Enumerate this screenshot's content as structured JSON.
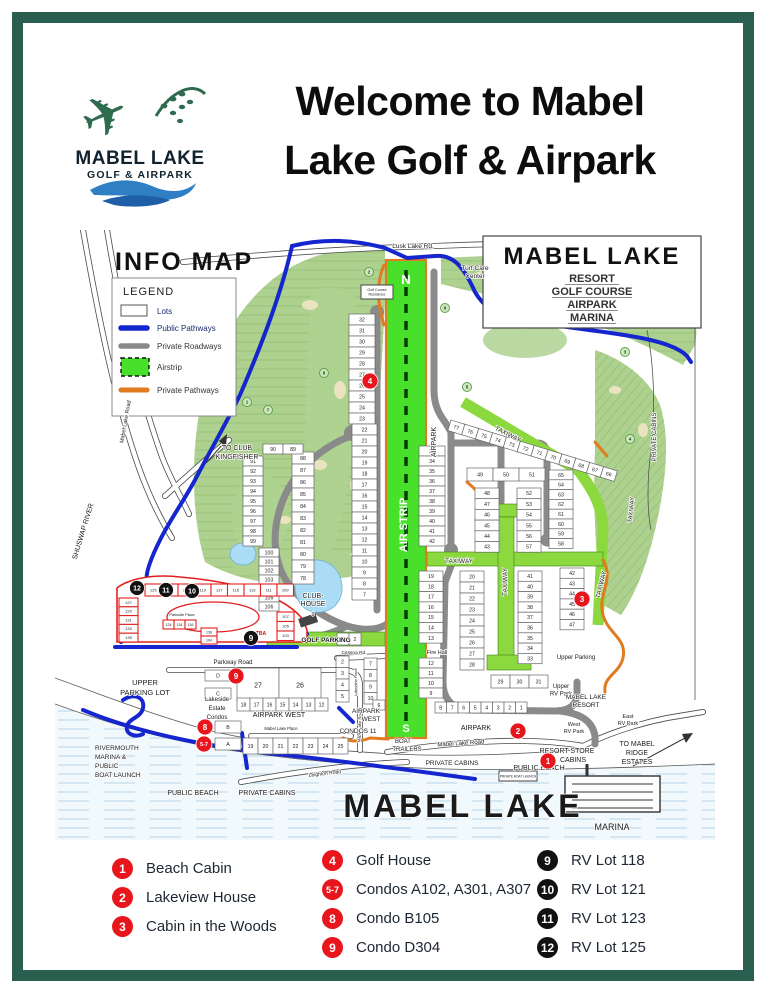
{
  "colors": {
    "border": "#2a5f50",
    "red": "#e8151d",
    "black": "#111111",
    "course": "#aed190",
    "airstrip": "#49e02c",
    "taxiway": "#8cd93f",
    "blue": "#1526cf",
    "gray": "#8a8a8a",
    "orange": "#e07b20",
    "water": "#f2f9fd",
    "redlot": "#e32020"
  },
  "logo": {
    "name": "MABEL LAKE",
    "subtitle": "GOLF & AIRPARK"
  },
  "header": {
    "title_line1": "Welcome to Mabel",
    "title_line2": "Lake Golf & Airpark"
  },
  "map": {
    "info_title": "INFO MAP",
    "legend": {
      "title": "LEGEND",
      "items": [
        {
          "label": "Lots",
          "type": "lots"
        },
        {
          "label": "Public Pathways",
          "type": "public-pathway"
        },
        {
          "label": "Private Roadways",
          "type": "private-roadway"
        },
        {
          "label": "Airstrip",
          "type": "airstrip"
        },
        {
          "label": "Private Pathways",
          "type": "private-pathway"
        }
      ]
    },
    "resort_box": {
      "title": "MABEL LAKE",
      "lines": [
        "RESORT",
        "GOLF COURSE",
        "AIRPARK",
        "MARINA"
      ]
    },
    "labels": [
      {
        "t": "Lusk Lake Rd.",
        "x": 358,
        "y": 18,
        "s": 6.5
      },
      {
        "t": "Turf Care",
        "x": 420,
        "y": 40,
        "s": 6.5
      },
      {
        "t": "Center",
        "x": 420,
        "y": 48,
        "s": 6.5
      },
      {
        "t": "Golf Course",
        "x": 322,
        "y": 61,
        "s": 3.6
      },
      {
        "t": "Residence",
        "x": 322,
        "y": 65.5,
        "s": 3.6
      },
      {
        "t": "TO CLUB",
        "x": 182,
        "y": 220,
        "s": 7
      },
      {
        "t": "KINGFISHER",
        "x": 182,
        "y": 229,
        "s": 7
      },
      {
        "t": "Mabel Lake Road",
        "x": 72,
        "y": 192,
        "s": 5.5,
        "r": -80
      },
      {
        "t": "SHUSWAP RIVER",
        "x": 30,
        "y": 302,
        "s": 7,
        "r": -73
      },
      {
        "t": "N",
        "x": 351,
        "y": 54,
        "s": 13,
        "b": true,
        "c": "#ffffff"
      },
      {
        "t": "AIR STRIP",
        "x": 352,
        "y": 295,
        "s": 11,
        "b": true,
        "c": "#ffffff",
        "r": -90
      },
      {
        "t": "S",
        "x": 351,
        "y": 502,
        "s": 11,
        "b": true,
        "c": "#ffffff"
      },
      {
        "t": "AIRPARK",
        "x": 381,
        "y": 212,
        "s": 7,
        "r": -90
      },
      {
        "t": "TAXIWAY",
        "x": 452,
        "y": 206,
        "s": 6.5,
        "r": 27
      },
      {
        "t": "TAXIWAY",
        "x": 578,
        "y": 280,
        "s": 6,
        "r": -84
      },
      {
        "t": "TAXIWAY",
        "x": 404,
        "y": 333,
        "s": 6.5
      },
      {
        "t": "TAXIWAY",
        "x": 452,
        "y": 352,
        "s": 6.5,
        "r": -90
      },
      {
        "t": "TAXIWAY",
        "x": 548,
        "y": 355,
        "s": 6.5,
        "r": -76
      },
      {
        "t": "CLUB-",
        "x": 258,
        "y": 368,
        "s": 7
      },
      {
        "t": "HOUSE",
        "x": 258,
        "y": 376,
        "s": 7
      },
      {
        "t": "9",
        "x": 258,
        "y": 386,
        "s": 5.5
      },
      {
        "t": "GOLF PARKING",
        "x": 271,
        "y": 412,
        "s": 6.5,
        "b": true
      },
      {
        "t": "Cessna Rd.",
        "x": 299,
        "y": 424,
        "s": 4.8
      },
      {
        "t": "Lakeview Place",
        "x": 302,
        "y": 452,
        "s": 4,
        "r": -90
      },
      {
        "t": "Fire Hall",
        "x": 382,
        "y": 424,
        "s": 5.5
      },
      {
        "t": "Upper Parking",
        "x": 521,
        "y": 429,
        "s": 6
      },
      {
        "t": "Upper",
        "x": 506,
        "y": 458,
        "s": 6
      },
      {
        "t": "RV Park",
        "x": 506,
        "y": 465.5,
        "s": 6
      },
      {
        "t": "MABEL LAKE",
        "x": 531,
        "y": 469,
        "s": 6.5
      },
      {
        "t": "RESORT",
        "x": 531,
        "y": 477,
        "s": 6.5
      },
      {
        "t": "West",
        "x": 519,
        "y": 496,
        "s": 5.5
      },
      {
        "t": "RV Park",
        "x": 519,
        "y": 503,
        "s": 5.5
      },
      {
        "t": "East",
        "x": 573,
        "y": 488,
        "s": 5.5
      },
      {
        "t": "RV Park",
        "x": 573,
        "y": 495,
        "s": 5.5
      },
      {
        "t": "AIRPARK",
        "x": 421,
        "y": 500,
        "s": 7
      },
      {
        "t": "Mabel Lake Road",
        "x": 406,
        "y": 515,
        "s": 6,
        "r": -4
      },
      {
        "t": "Mabel Lake Road",
        "x": 306,
        "y": 496,
        "s": 4.2,
        "r": -88
      },
      {
        "t": "AIRPARK",
        "x": 311,
        "y": 483,
        "s": 6.5
      },
      {
        "t": "WEST",
        "x": 316,
        "y": 491,
        "s": 6.5
      },
      {
        "t": "CONDOS 11",
        "x": 303,
        "y": 503,
        "s": 6.5
      },
      {
        "t": "BOAT",
        "x": 348,
        "y": 513,
        "s": 6
      },
      {
        "t": "TRAILERS",
        "x": 352,
        "y": 521,
        "s": 6
      },
      {
        "t": "Parkside Place",
        "x": 127,
        "y": 386,
        "s": 3.8
      },
      {
        "t": "TBA",
        "x": 206,
        "y": 405,
        "s": 5,
        "b": true,
        "c": "#cc1111"
      },
      {
        "t": "Parkway Road",
        "x": 178,
        "y": 434,
        "s": 6
      },
      {
        "t": "UPPER",
        "x": 90,
        "y": 455,
        "s": 7.5
      },
      {
        "t": "PARKING LOT",
        "x": 90,
        "y": 465,
        "s": 7.5
      },
      {
        "t": "Lakeside",
        "x": 162,
        "y": 471,
        "s": 6
      },
      {
        "t": "Estate",
        "x": 162,
        "y": 480,
        "s": 6
      },
      {
        "t": "Condos",
        "x": 162,
        "y": 489,
        "s": 6
      },
      {
        "t": "AIRPARK WEST",
        "x": 224,
        "y": 487,
        "s": 7
      },
      {
        "t": "Mabel Lake Place",
        "x": 226,
        "y": 500,
        "s": 4.2
      },
      {
        "t": "Leighton Road",
        "x": 270,
        "y": 545,
        "s": 5,
        "r": -7
      },
      {
        "t": "PRIVATE CABINS",
        "x": 212,
        "y": 565,
        "s": 7
      },
      {
        "t": "PRIVATE CABINS",
        "x": 397,
        "y": 535,
        "s": 6.5
      },
      {
        "t": "PRIVATE CABINS",
        "x": 601,
        "y": 207,
        "s": 6,
        "r": -90
      },
      {
        "t": "RIVERMOUTH",
        "x": 40,
        "y": 520,
        "s": 6.5,
        "a": "start"
      },
      {
        "t": "MARINA &",
        "x": 40,
        "y": 529,
        "s": 6.5,
        "a": "start"
      },
      {
        "t": "PUBLIC",
        "x": 40,
        "y": 538,
        "s": 6.5,
        "a": "start"
      },
      {
        "t": "BOAT LAUNCH",
        "x": 40,
        "y": 547,
        "s": 6.5,
        "a": "start"
      },
      {
        "t": "PUBLIC BEACH",
        "x": 138,
        "y": 565,
        "s": 7
      },
      {
        "t": "PUBLIC BEACH",
        "x": 484,
        "y": 540,
        "s": 7
      },
      {
        "t": "RESORT STORE",
        "x": 512,
        "y": 523,
        "s": 7
      },
      {
        "t": "CABINS",
        "x": 518,
        "y": 532,
        "s": 7
      },
      {
        "t": "TO MABEL",
        "x": 582,
        "y": 516,
        "s": 7
      },
      {
        "t": "RIDGE",
        "x": 582,
        "y": 525,
        "s": 7
      },
      {
        "t": "ESTATES",
        "x": 582,
        "y": 534,
        "s": 7
      },
      {
        "t": "MABEL LAKE",
        "x": 408,
        "y": 587,
        "s": 32,
        "w": "600",
        "sp": 3
      },
      {
        "t": "MARINA",
        "x": 557,
        "y": 600,
        "s": 9
      },
      {
        "t": "PRIVATE BOAT LAUNCH",
        "x": 463,
        "y": 547.5,
        "s": 3.2
      }
    ],
    "holes": [
      {
        "n": "1",
        "x": 192,
        "y": 172
      },
      {
        "n": "7",
        "x": 213,
        "y": 180
      },
      {
        "n": "8",
        "x": 269,
        "y": 143
      },
      {
        "n": "2",
        "x": 314,
        "y": 42
      },
      {
        "n": "6",
        "x": 390,
        "y": 78
      },
      {
        "n": "5",
        "x": 412,
        "y": 157
      },
      {
        "n": "3",
        "x": 570,
        "y": 122
      },
      {
        "n": "4",
        "x": 575,
        "y": 209
      }
    ],
    "lot_groups": [
      {
        "x": 294,
        "y": 84,
        "cw": 26,
        "ch": 11,
        "dir": "v",
        "nums": [
          "32",
          "31",
          "30",
          "29",
          "28",
          "27",
          "26",
          "25",
          "24",
          "23"
        ]
      },
      {
        "x": 297,
        "y": 194,
        "cw": 25,
        "ch": 11,
        "dir": "v",
        "nums": [
          "22",
          "21",
          "20",
          "19",
          "18",
          "17",
          "16",
          "15",
          "14",
          "13",
          "12",
          "11",
          "10",
          "9",
          "8",
          "7"
        ]
      },
      {
        "x": 282,
        "y": 403,
        "cw": 12,
        "ch": 12,
        "dir": "h",
        "nums": [
          "1",
          "2"
        ]
      },
      {
        "x": 237,
        "y": 222,
        "cw": 22,
        "ch": 12,
        "dir": "v",
        "nums": [
          "88",
          "87",
          "86",
          "85",
          "84",
          "83",
          "82",
          "81",
          "80",
          "79",
          "78"
        ]
      },
      {
        "x": 208,
        "y": 214,
        "cw": 20,
        "ch": 10,
        "dir": "h",
        "nums": [
          "90",
          "89"
        ]
      },
      {
        "x": 188,
        "y": 226,
        "cw": 20,
        "ch": 10,
        "dir": "v",
        "nums": [
          "91",
          "92",
          "93",
          "94",
          "95",
          "96",
          "97",
          "98",
          "99"
        ]
      },
      {
        "x": 204,
        "y": 318,
        "cw": 20,
        "ch": 9,
        "dir": "v",
        "nums": [
          "100",
          "101",
          "102",
          "103",
          "104",
          "105",
          "106"
        ]
      },
      {
        "x": 364,
        "y": 216,
        "cw": 26,
        "ch": 10,
        "dir": "v",
        "nums": [
          "33",
          "34",
          "35",
          "36",
          "37",
          "38",
          "39",
          "40",
          "41",
          "42"
        ]
      },
      {
        "x": 396,
        "y": 190,
        "cw": 14.5,
        "ch": 11,
        "dir": "h",
        "rot": 17,
        "nums": [
          "77",
          "76",
          "75",
          "74",
          "73",
          "72",
          "71",
          "70",
          "69",
          "68",
          "67",
          "66"
        ]
      },
      {
        "x": 412,
        "y": 238,
        "cw": 26,
        "ch": 13,
        "dir": "h",
        "nums": [
          "49",
          "50",
          "51"
        ]
      },
      {
        "x": 420,
        "y": 258,
        "cw": 24,
        "ch": 10.7,
        "dir": "v",
        "nums": [
          "48",
          "47",
          "46",
          "45",
          "44",
          "43"
        ]
      },
      {
        "x": 462,
        "y": 258,
        "cw": 24,
        "ch": 10.7,
        "dir": "v",
        "nums": [
          "52",
          "53",
          "54",
          "55",
          "56",
          "57"
        ]
      },
      {
        "x": 494,
        "y": 240,
        "cw": 24,
        "ch": 9.8,
        "dir": "v",
        "nums": [
          "65",
          "64",
          "63",
          "62",
          "61",
          "60",
          "59",
          "58"
        ]
      },
      {
        "x": 364,
        "y": 341,
        "cw": 24,
        "ch": 10.3,
        "dir": "v",
        "nums": [
          "19",
          "18",
          "17",
          "16",
          "15",
          "14",
          "13"
        ]
      },
      {
        "x": 364,
        "y": 428,
        "cw": 24,
        "ch": 10,
        "dir": "v",
        "nums": [
          "12",
          "11",
          "10",
          "9"
        ]
      },
      {
        "x": 380,
        "y": 472,
        "cw": 11.5,
        "ch": 11,
        "dir": "h",
        "nums": [
          "8",
          "7",
          "6",
          "5",
          "4",
          "3",
          "2",
          "1"
        ]
      },
      {
        "x": 405,
        "y": 341,
        "cw": 24,
        "ch": 11,
        "dir": "v",
        "nums": [
          "20",
          "21",
          "22",
          "23",
          "24",
          "25",
          "26",
          "27",
          "28"
        ]
      },
      {
        "x": 436,
        "y": 445,
        "cw": 19,
        "ch": 13,
        "dir": "h",
        "nums": [
          "29",
          "30",
          "31"
        ]
      },
      {
        "x": 463,
        "y": 341,
        "cw": 24,
        "ch": 10.3,
        "dir": "v",
        "nums": [
          "41",
          "40",
          "39",
          "38",
          "37",
          "36",
          "35",
          "34",
          "33"
        ]
      },
      {
        "x": 505,
        "y": 338,
        "cw": 24,
        "ch": 10.3,
        "dir": "v",
        "nums": [
          "42",
          "43",
          "44",
          "45",
          "46",
          "47"
        ]
      },
      {
        "x": 150,
        "y": 440,
        "cw": 26,
        "ch": 11,
        "dir": "v",
        "nums": [
          "D"
        ]
      },
      {
        "x": 150,
        "y": 458,
        "cw": 26,
        "ch": 11,
        "dir": "v",
        "nums": [
          "C"
        ]
      },
      {
        "x": 160,
        "y": 491,
        "cw": 26,
        "ch": 12,
        "dir": "v",
        "nums": [
          "B"
        ]
      },
      {
        "x": 160,
        "y": 508,
        "cw": 26,
        "ch": 12,
        "dir": "v",
        "nums": [
          "A"
        ]
      },
      {
        "x": 182,
        "y": 438,
        "cw": 42,
        "ch": 34,
        "dir": "h",
        "fs": 7,
        "nums": [
          "27",
          "26"
        ]
      },
      {
        "x": 182,
        "y": 468,
        "cw": 13,
        "ch": 13,
        "dir": "h",
        "nums": [
          "18",
          "17",
          "16",
          "15",
          "14",
          "13",
          "12"
        ]
      },
      {
        "x": 188,
        "y": 508,
        "cw": 15,
        "ch": 16,
        "dir": "h",
        "nums": [
          "19",
          "20",
          "21",
          "22",
          "23",
          "24",
          "25"
        ]
      },
      {
        "x": 281,
        "y": 426,
        "cw": 13,
        "ch": 11.5,
        "dir": "v",
        "nums": [
          "2",
          "3",
          "4",
          "5"
        ]
      },
      {
        "x": 309,
        "y": 428,
        "cw": 13,
        "ch": 11.5,
        "dir": "v",
        "nums": [
          "7",
          "8",
          "9",
          "10"
        ]
      },
      {
        "x": 318,
        "y": 470,
        "cw": 12,
        "ch": 10,
        "dir": "v",
        "nums": [
          "6"
        ]
      },
      {
        "x": 90,
        "y": 354,
        "cw": 16.5,
        "ch": 12,
        "dir": "h",
        "cls": "red",
        "fs": 4,
        "nums": [
          "125",
          "123",
          "121",
          "119",
          "117",
          "115",
          "113",
          "111",
          "109"
        ]
      },
      {
        "x": 64,
        "y": 368,
        "cw": 19,
        "ch": 8.8,
        "dir": "v",
        "cls": "red",
        "fs": 4,
        "nums": [
          "127",
          "129",
          "131",
          "133",
          "135"
        ]
      },
      {
        "x": 222,
        "y": 382,
        "cw": 17,
        "ch": 9.5,
        "dir": "v",
        "cls": "red",
        "fs": 4,
        "nums": [
          "107",
          "105",
          "103"
        ]
      },
      {
        "x": 108,
        "y": 390,
        "cw": 11,
        "ch": 9,
        "dir": "h",
        "cls": "red",
        "fs": 3.6,
        "nums": [
          "124",
          "118",
          "116"
        ]
      },
      {
        "x": 146,
        "y": 398,
        "cw": 16,
        "ch": 8,
        "dir": "v",
        "cls": "red",
        "fs": 3.6,
        "nums": [
          "136",
          "104"
        ]
      }
    ],
    "markers": {
      "red": [
        {
          "n": "1",
          "x": 493,
          "y": 531
        },
        {
          "n": "2",
          "x": 463,
          "y": 501
        },
        {
          "n": "3",
          "x": 527,
          "y": 369
        },
        {
          "n": "4",
          "x": 315,
          "y": 151
        },
        {
          "n": "5-7",
          "x": 149,
          "y": 514
        },
        {
          "n": "8",
          "x": 150,
          "y": 497
        },
        {
          "n": "9",
          "x": 181,
          "y": 446
        }
      ],
      "black": [
        {
          "n": "9",
          "x": 196,
          "y": 408
        },
        {
          "n": "10",
          "x": 137,
          "y": 361
        },
        {
          "n": "11",
          "x": 111,
          "y": 360
        },
        {
          "n": "12",
          "x": 82,
          "y": 358
        }
      ]
    }
  },
  "footer": {
    "columns": [
      {
        "items": [
          {
            "num": "1",
            "color": "red",
            "label": "Beach Cabin"
          },
          {
            "num": "2",
            "color": "red",
            "label": "Lakeview House"
          },
          {
            "num": "3",
            "color": "red",
            "label": "Cabin in the Woods"
          }
        ]
      },
      {
        "items": [
          {
            "num": "4",
            "color": "red",
            "label": "Golf House"
          },
          {
            "num": "5-7",
            "color": "red",
            "label": "Condos A102, A301, A307"
          },
          {
            "num": "8",
            "color": "red",
            "label": "Condo B105"
          },
          {
            "num": "9",
            "color": "red",
            "label": "Condo D304"
          }
        ]
      },
      {
        "items": [
          {
            "num": "9",
            "color": "black",
            "label": "RV Lot 118"
          },
          {
            "num": "10",
            "color": "black",
            "label": "RV Lot 121"
          },
          {
            "num": "11",
            "color": "black",
            "label": "RV Lot 123"
          },
          {
            "num": "12",
            "color": "black",
            "label": "RV Lot 125"
          }
        ]
      }
    ]
  }
}
